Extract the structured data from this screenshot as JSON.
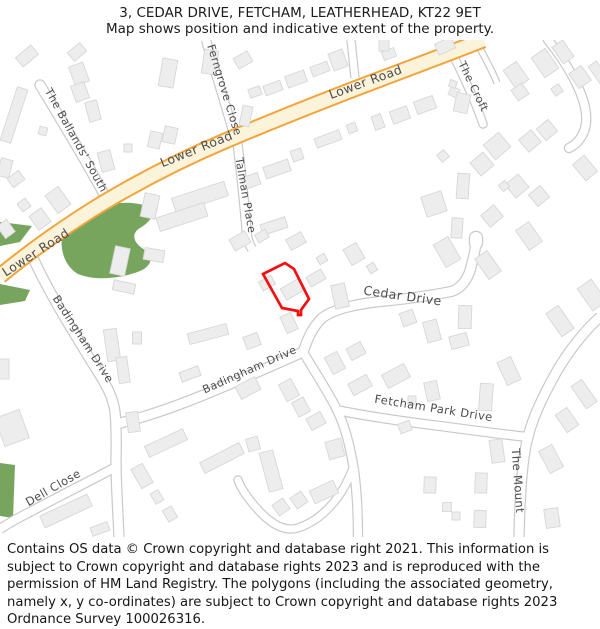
{
  "header": {
    "title": "3, CEDAR DRIVE, FETCHAM, LEATHERHEAD, KT22 9ET",
    "subtitle": "Map shows position and indicative extent of the property."
  },
  "footer": {
    "text": "Contains OS data © Crown copyright and database right 2021. This information is subject to Crown copyright and database rights 2023 and is reproduced with the permission of HM Land Registry. The polygons (including the associated geometry, namely x, y co-ordinates) are subject to Crown copyright and database rights 2023 Ordnance Survey 100026316."
  },
  "map": {
    "colors": {
      "background": "#ffffff",
      "road_fill": "#ffffff",
      "road_casing": "#c9c9c9",
      "highlight_fill": "#fbf3da",
      "highlight_casing": "#f2a43d",
      "building": "#ededed",
      "building_stroke": "#d7d7d7",
      "green": "#78a55e",
      "label": "#4d4d4d",
      "property": "#f50f0f"
    },
    "greens": [
      {
        "d": "M 62,238 C 75,222 90,210 103,206 C 120,201 140,202 150,208 C 156,214 150,222 140,228 C 130,234 134,244 145,250 C 154,256 152,266 140,271 C 120,279 95,281 78,274 C 66,267 60,252 62,238 Z"
      },
      {
        "d": "M 0,222 L 32,226 L 20,242 L 0,246 Z"
      },
      {
        "d": "M 0,284 L 30,290 L 25,301 L 0,305 Z"
      },
      {
        "d": "M 0,463 L 15,465 L 13,518 L 0,516 Z"
      }
    ],
    "roads": [
      {
        "name": "ballands-south",
        "d": "M 40,85 C 52,105 80,150 106,198",
        "w": 9,
        "cap": "round"
      },
      {
        "name": "ferngrove-close",
        "d": "M 206,40 C 215,72 226,105 234,135",
        "w": 8
      },
      {
        "name": "talman-place",
        "d": "M 237,140 C 241,170 244,200 247,235 C 248,242 250,246 252,249",
        "w": 8
      },
      {
        "name": "the-croft",
        "d": "M 452,53 C 462,73 475,100 483,124",
        "w": 7,
        "cap": "round"
      },
      {
        "name": "croft-path",
        "d": "M 477,43 C 484,56 492,70 497,83",
        "w": 5
      },
      {
        "name": "north-side-road",
        "d": "M 351,40 L 355,78",
        "w": 7
      },
      {
        "name": "ne-cul-de-sac",
        "d": "M 548,40 C 566,62 584,92 586,114 C 588,132 578,144 569,148",
        "w": 8,
        "cap": "round"
      },
      {
        "name": "badingham-drive",
        "d": "M 33,258 C 50,295 75,335 98,372 C 108,388 113,398 115,412 C 117,432 116,448 116,462 C 116,484 118,512 119,537",
        "w": 9
      },
      {
        "name": "dell-close",
        "d": "M 114,468 C 88,482 52,500 28,513 C 16,519 6,525 0,529",
        "w": 8
      },
      {
        "name": "badingham-drive-ne",
        "d": "M 116,424 C 170,412 235,382 303,352",
        "w": 9
      },
      {
        "name": "fetcham-link",
        "d": "M 303,352 C 315,372 330,395 337,410 C 344,424 350,445 354,470 C 357,492 358,515 358,537",
        "w": 8
      },
      {
        "name": "fetcham-park-drive",
        "d": "M 337,410 C 365,416 400,421 440,426 C 470,430 500,434 527,437",
        "w": 8
      },
      {
        "name": "the-mount",
        "d": "M 600,317 C 585,330 565,355 552,380 C 540,402 532,420 528,437 C 523,455 520,490 519,537",
        "w": 9
      },
      {
        "name": "bottom-loop",
        "d": "M 353,468 C 342,498 322,520 298,528 C 284,532 272,524 260,512 C 250,501 241,489 238,480",
        "w": 7,
        "cap": "round"
      },
      {
        "name": "cedar-drive",
        "d": "M 303,352 C 308,338 312,328 322,318 C 335,308 360,303 395,300 C 420,297 440,294 453,291 C 462,287 468,279 471,267 C 474,256 476,246 476,240",
        "w": 9,
        "cap": "round"
      },
      {
        "name": "cedar-drive-bulb",
        "d": "M 476,243 L 476,238",
        "w": 12,
        "cap": "round"
      },
      {
        "name": "lower-road",
        "d": "M 483,40 C 450,53 410,68 370,83 C 320,102 270,122 225,141 C 180,160 135,184 103,203 C 75,220 35,247 0,276",
        "w": 13,
        "highlight": true
      }
    ],
    "buildings": [
      [
        27,
        56,
        20,
        12,
        -40
      ],
      [
        77,
        52,
        16,
        11,
        -40
      ],
      [
        14,
        115,
        11,
        56,
        18
      ],
      [
        43,
        131,
        8,
        8,
        15
      ],
      [
        79,
        74,
        15,
        20,
        -20
      ],
      [
        80,
        92,
        14,
        17,
        -20
      ],
      [
        93,
        111,
        12,
        20,
        -15
      ],
      [
        106,
        161,
        13,
        20,
        -15
      ],
      [
        128,
        148,
        8,
        8,
        0
      ],
      [
        5,
        168,
        12,
        18,
        14
      ],
      [
        16,
        179,
        14,
        11,
        -36
      ],
      [
        24,
        205,
        10,
        10,
        -36
      ],
      [
        58,
        200,
        16,
        22,
        -36
      ],
      [
        40,
        219,
        15,
        17,
        -36
      ],
      [
        6,
        229,
        12,
        15,
        -36
      ],
      [
        150,
        206,
        15,
        24,
        12
      ],
      [
        120,
        261,
        15,
        28,
        12
      ],
      [
        154,
        255,
        20,
        12,
        10
      ],
      [
        124,
        287,
        22,
        10,
        12
      ],
      [
        4,
        369,
        10,
        20,
        0
      ],
      [
        12,
        428,
        26,
        30,
        -20
      ],
      [
        112,
        345,
        13,
        32,
        -8
      ],
      [
        123,
        370,
        11,
        26,
        -8
      ],
      [
        137,
        338,
        9,
        12,
        0
      ],
      [
        133,
        422,
        12,
        20,
        -8
      ],
      [
        168,
        73,
        15,
        28,
        10
      ],
      [
        210,
        62,
        14,
        24,
        8
      ],
      [
        243,
        60,
        16,
        12,
        -30
      ],
      [
        246,
        116,
        10,
        20,
        12
      ],
      [
        445,
        46,
        18,
        12,
        -25
      ],
      [
        155,
        140,
        12,
        16,
        12
      ],
      [
        170,
        135,
        13,
        16,
        12
      ],
      [
        200,
        197,
        55,
        15,
        -18
      ],
      [
        182,
        217,
        50,
        14,
        -18
      ],
      [
        251,
        181,
        17,
        12,
        -19
      ],
      [
        277,
        169,
        26,
        12,
        -19
      ],
      [
        297,
        155,
        11,
        11,
        -19
      ],
      [
        274,
        226,
        26,
        11,
        -18
      ],
      [
        255,
        92,
        12,
        9,
        -20
      ],
      [
        273,
        88,
        18,
        10,
        -20
      ],
      [
        296,
        79,
        20,
        12,
        -20
      ],
      [
        320,
        69,
        18,
        10,
        -20
      ],
      [
        338,
        60,
        15,
        18,
        -20
      ],
      [
        389,
        54,
        13,
        9,
        -20
      ],
      [
        384,
        45,
        10,
        12,
        0
      ],
      [
        352,
        128,
        9,
        9,
        -20
      ],
      [
        378,
        122,
        10,
        14,
        -20
      ],
      [
        328,
        139,
        26,
        10,
        -20
      ],
      [
        400,
        115,
        18,
        13,
        -20
      ],
      [
        425,
        105,
        20,
        13,
        -20
      ],
      [
        454,
        92,
        9,
        9,
        25
      ],
      [
        462,
        103,
        14,
        19,
        12
      ],
      [
        453,
        84,
        7,
        7,
        20
      ],
      [
        516,
        75,
        16,
        22,
        -35
      ],
      [
        545,
        63,
        17,
        24,
        -35
      ],
      [
        563,
        52,
        13,
        20,
        -35
      ],
      [
        580,
        77,
        15,
        18,
        -35
      ],
      [
        598,
        72,
        10,
        20,
        -35
      ],
      [
        557,
        90,
        9,
        9,
        -35
      ],
      [
        520,
        92,
        13,
        13,
        -35
      ],
      [
        497,
        146,
        20,
        19,
        -40
      ],
      [
        482,
        164,
        17,
        17,
        -40
      ],
      [
        530,
        141,
        16,
        16,
        -40
      ],
      [
        547,
        130,
        15,
        15,
        -40
      ],
      [
        443,
        156,
        9,
        9,
        -40
      ],
      [
        463,
        186,
        12,
        25,
        4
      ],
      [
        434,
        204,
        21,
        21,
        -18
      ],
      [
        517,
        186,
        17,
        17,
        -40
      ],
      [
        539,
        196,
        15,
        15,
        -40
      ],
      [
        504,
        186,
        8,
        8,
        -40
      ],
      [
        492,
        216,
        17,
        15,
        -40
      ],
      [
        457,
        228,
        11,
        20,
        4
      ],
      [
        585,
        168,
        15,
        21,
        -40
      ],
      [
        240,
        241,
        18,
        13,
        -30
      ],
      [
        262,
        236,
        12,
        9,
        -30
      ],
      [
        296,
        241,
        17,
        12,
        -30
      ],
      [
        354,
        254,
        15,
        18,
        -30
      ],
      [
        322,
        259,
        9,
        8,
        -30
      ],
      [
        267,
        283,
        14,
        10,
        -30
      ],
      [
        293,
        289,
        22,
        13,
        -30
      ],
      [
        316,
        278,
        17,
        11,
        -30
      ],
      [
        340,
        296,
        14,
        24,
        -12
      ],
      [
        372,
        268,
        8,
        9,
        -30
      ],
      [
        447,
        252,
        17,
        26,
        -30
      ],
      [
        488,
        265,
        15,
        25,
        -35
      ],
      [
        529,
        236,
        16,
        24,
        -35
      ],
      [
        465,
        317,
        13,
        23,
        2
      ],
      [
        408,
        318,
        14,
        14,
        -20
      ],
      [
        432,
        331,
        14,
        21,
        -15
      ],
      [
        459,
        341,
        18,
        13,
        -15
      ],
      [
        592,
        295,
        17,
        27,
        -35
      ],
      [
        560,
        321,
        15,
        28,
        -35
      ],
      [
        289,
        323,
        12,
        18,
        -25
      ],
      [
        208,
        334,
        40,
        11,
        -15
      ],
      [
        252,
        341,
        15,
        13,
        -20
      ],
      [
        190,
        374,
        20,
        10,
        -20
      ],
      [
        248,
        388,
        22,
        14,
        -28
      ],
      [
        289,
        390,
        14,
        19,
        -28
      ],
      [
        301,
        407,
        13,
        16,
        -28
      ],
      [
        316,
        421,
        16,
        13,
        -28
      ],
      [
        335,
        363,
        14,
        19,
        -28
      ],
      [
        356,
        351,
        16,
        13,
        -28
      ],
      [
        396,
        376,
        25,
        15,
        -28
      ],
      [
        360,
        385,
        21,
        13,
        -28
      ],
      [
        432,
        391,
        13,
        19,
        -12
      ],
      [
        486,
        397,
        13,
        27,
        4
      ],
      [
        412,
        400,
        8,
        8,
        0
      ],
      [
        405,
        427,
        12,
        10,
        -20
      ],
      [
        509,
        371,
        15,
        25,
        -25
      ],
      [
        166,
        443,
        42,
        12,
        -25
      ],
      [
        222,
        458,
        44,
        12,
        -27
      ],
      [
        66,
        511,
        52,
        13,
        -25
      ],
      [
        100,
        529,
        18,
        9,
        -20
      ],
      [
        142,
        476,
        13,
        22,
        -30
      ],
      [
        157,
        497,
        9,
        12,
        -30
      ],
      [
        170,
        514,
        10,
        13,
        -30
      ],
      [
        271,
        471,
        14,
        40,
        -15
      ],
      [
        281,
        507,
        13,
        13,
        -35
      ],
      [
        299,
        500,
        13,
        13,
        -35
      ],
      [
        324,
        492,
        26,
        14,
        -25
      ],
      [
        335,
        449,
        16,
        18,
        -15
      ],
      [
        253,
        444,
        12,
        13,
        -15
      ],
      [
        497,
        451,
        13,
        23,
        -8
      ],
      [
        551,
        459,
        15,
        25,
        -28
      ],
      [
        552,
        518,
        14,
        19,
        -8
      ],
      [
        481,
        483,
        12,
        20,
        2
      ],
      [
        480,
        519,
        12,
        17,
        2
      ],
      [
        430,
        485,
        12,
        16,
        2
      ],
      [
        447,
        507,
        9,
        9,
        0
      ],
      [
        456,
        516,
        8,
        8,
        0
      ],
      [
        584,
        394,
        13,
        27,
        -35
      ],
      [
        567,
        420,
        14,
        21,
        -35
      ]
    ],
    "labels": [
      {
        "text": "Lower Road",
        "x": 367,
        "y": 86,
        "rot": -20,
        "size": 12.5
      },
      {
        "text": "Lower Road",
        "x": 198,
        "y": 153,
        "rot": -22,
        "size": 12.5
      },
      {
        "text": "Lower Road",
        "x": 38,
        "y": 256,
        "rot": -33,
        "size": 12.5
      },
      {
        "text": "The Ballands' South",
        "x": 73,
        "y": 142,
        "rot": 61,
        "size": 11
      },
      {
        "text": "Ferngrove Close",
        "x": 221,
        "y": 91,
        "rot": 73,
        "size": 11
      },
      {
        "text": "Talman Place",
        "x": 242,
        "y": 196,
        "rot": 80,
        "size": 11
      },
      {
        "text": "The Croft",
        "x": 470,
        "y": 88,
        "rot": 64,
        "size": 11
      },
      {
        "text": "Cedar Drive",
        "x": 402,
        "y": 300,
        "rot": 8,
        "size": 12.5
      },
      {
        "text": "Badingham Drive",
        "x": 80,
        "y": 341,
        "rot": 57,
        "size": 11
      },
      {
        "text": "Badingham Drive",
        "x": 251,
        "y": 373,
        "rot": -24,
        "size": 11
      },
      {
        "text": "Fetcham Park Drive",
        "x": 433,
        "y": 412,
        "rot": 9,
        "size": 11.5
      },
      {
        "text": "Dell Close",
        "x": 55,
        "y": 491,
        "rot": -30,
        "size": 11.5
      },
      {
        "text": "The Mount",
        "x": 514,
        "y": 481,
        "rot": 86,
        "size": 11.5
      }
    ],
    "property": {
      "points": "285,263 294,269 309,299 301,310 301,315 298,315 298,311 282,308 263,274",
      "stroke_width": 2.7
    }
  }
}
